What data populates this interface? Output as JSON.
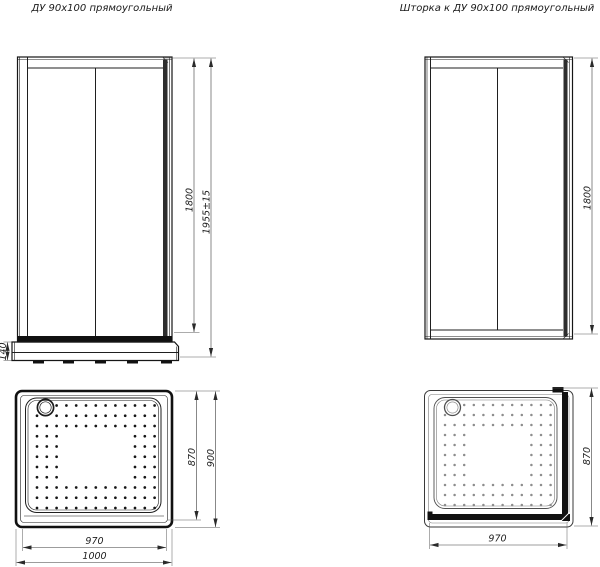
{
  "titles": {
    "left": "ДУ 90x100 прямоугольный",
    "right": "Шторка к ДУ 90x100 прямоугольный"
  },
  "door_front": {
    "dim_height": "1800",
    "dim_total": "1955±15",
    "dim_base": "140"
  },
  "screen_side": {
    "dim_height": "1800"
  },
  "tray_left": {
    "dim_inner_depth": "870",
    "dim_outer_depth": "900",
    "dim_inner_width": "970",
    "dim_outer_width": "1000"
  },
  "tray_right": {
    "dim_depth": "870",
    "dim_width": "970"
  },
  "colors": {
    "ink": "#1c1c1c",
    "ink_light": "#7a7a7a",
    "background": "#ffffff"
  }
}
